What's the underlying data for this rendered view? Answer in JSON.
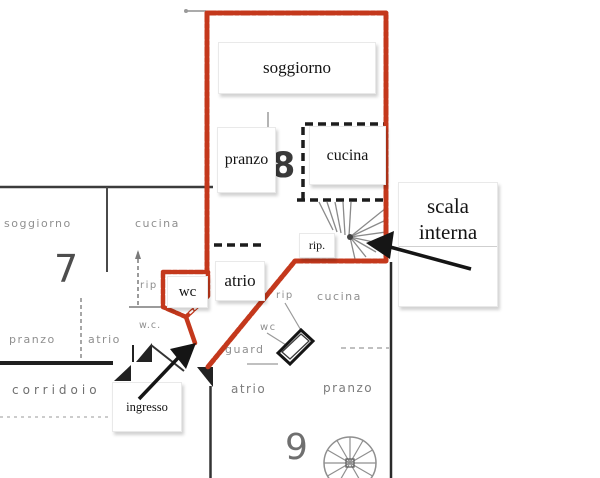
{
  "colors": {
    "highlight": "#c4381c",
    "arrow": "#151515",
    "faded_text": "#8f8f8f"
  },
  "unit8": {
    "number": "8",
    "labels": {
      "soggiorno": "soggiorno",
      "pranzo": "pranzo",
      "cucina": "cucina",
      "atrio": "atrio",
      "wc": "wc",
      "rip": "rip."
    }
  },
  "unit7": {
    "number": "7",
    "labels": {
      "soggiorno": "soggiorno",
      "cucina": "cucina",
      "rip": "rip",
      "pranzo": "pranzo",
      "atrio": "atrio",
      "wc": "w.c.",
      "corridoio": "corridoio"
    }
  },
  "unit9": {
    "number": "9",
    "labels": {
      "rip": "rip",
      "cucina": "cucina",
      "wc": "wc",
      "guard": "guard",
      "atrio": "atrio",
      "pranzo": "pranzo"
    }
  },
  "annotations": {
    "scala_line1": "scala",
    "scala_line2": "interna",
    "ingresso": "ingresso"
  }
}
